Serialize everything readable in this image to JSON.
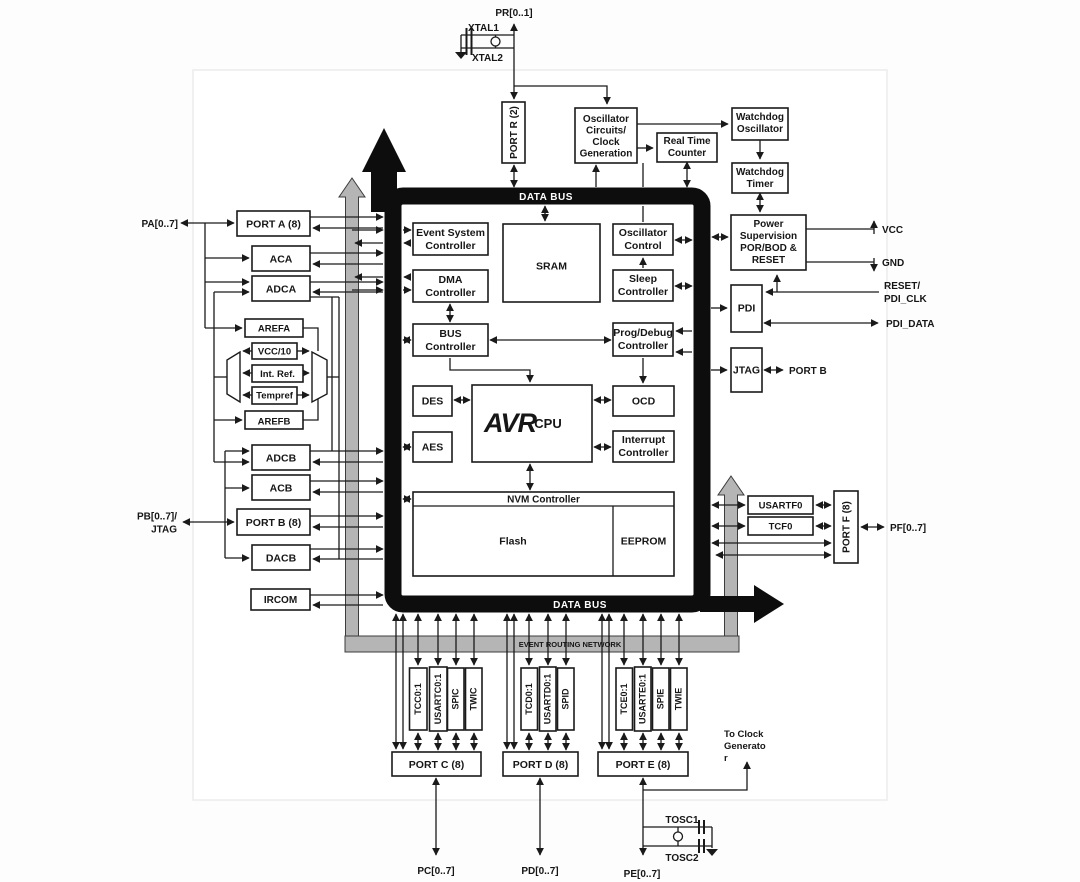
{
  "buses": {
    "data_bus": "DATA BUS",
    "event_routing": "EVENT ROUTING NETWORK"
  },
  "clock_top": {
    "pr_pin": "PR[0..1]",
    "xtal1": "XTAL1",
    "xtal2": "XTAL2",
    "port_r": "PORT R (2)",
    "oscillator_circuits": [
      "Oscillator",
      "Circuits/",
      "Clock",
      "Generation"
    ],
    "real_time_counter": [
      "Real Time",
      "Counter"
    ],
    "watchdog_oscillator": [
      "Watchdog",
      "Oscillator"
    ],
    "watchdog_timer": [
      "Watchdog",
      "Timer"
    ]
  },
  "power_right": {
    "power_supervision": [
      "Power",
      "Supervision",
      "POR/BOD &",
      "RESET"
    ],
    "vcc_pin": "VCC",
    "gnd_pin": "GND",
    "reset_pin": [
      "RESET/",
      "PDI_CLK"
    ],
    "pdi_data_pin": "PDI_DATA",
    "pdi": "PDI",
    "jtag": "JTAG",
    "port_b_pin": "PORT B"
  },
  "left": {
    "pa_pin": "PA[0..7]",
    "port_a": "PORT A (8)",
    "aca": "ACA",
    "adca": "ADCA",
    "arefa": "AREFA",
    "vcc_10": "VCC/10",
    "int_ref": "Int. Ref.",
    "tempref": "Tempref",
    "arefb": "AREFB",
    "adcb": "ADCB",
    "acb": "ACB",
    "port_b": "PORT B (8)",
    "pb_pin": [
      "PB[0..7]/",
      "JTAG"
    ],
    "dacb": "DACB",
    "ircom": "IRCOM"
  },
  "core": {
    "event_system": [
      "Event System",
      "Controller"
    ],
    "dma": [
      "DMA",
      "Controller"
    ],
    "bus_ctrl": [
      "BUS",
      "Controller"
    ],
    "sram": "SRAM",
    "oscillator_control": [
      "Oscillator",
      "Control"
    ],
    "sleep": [
      "Sleep",
      "Controller"
    ],
    "prog_debug": [
      "Prog/Debug",
      "Controller"
    ],
    "des": "DES",
    "aes": "AES",
    "avr": "AVR",
    "cpu": "CPU",
    "ocd": "OCD",
    "interrupt": [
      "Interrupt",
      "Controller"
    ],
    "nvm": "NVM Controller",
    "flash": "Flash",
    "eeprom": "EEPROM"
  },
  "right_io": {
    "usartf0": "USARTF0",
    "tcf0": "TCF0",
    "port_f": "PORT F (8)",
    "pf_pin": "PF[0..7]"
  },
  "bottom": {
    "port_c_periphs": [
      "TCC0:1",
      "USARTC0:1",
      "SPIC",
      "TWIC"
    ],
    "port_d_periphs": [
      "TCD0:1",
      "USARTD0:1",
      "SPID"
    ],
    "port_e_periphs": [
      "TCE0:1",
      "USARTE0:1",
      "SPIE",
      "TWIE"
    ],
    "port_c": "PORT C (8)",
    "port_d": "PORT D (8)",
    "port_e": "PORT E (8)",
    "pc_pin": "PC[0..7]",
    "pd_pin": "PD[0..7]",
    "pe_pin": "PE[0..7]",
    "to_clock": [
      "To Clock",
      "Generato",
      "r"
    ],
    "tosc1": "TOSC1",
    "tosc2": "TOSC2"
  },
  "colors": {
    "line": "#1a1a1a",
    "bus_black": "#0d0d0d",
    "bus_gray": "#b5b5b5",
    "box_fill": "#ffffff",
    "label": "#161616"
  }
}
